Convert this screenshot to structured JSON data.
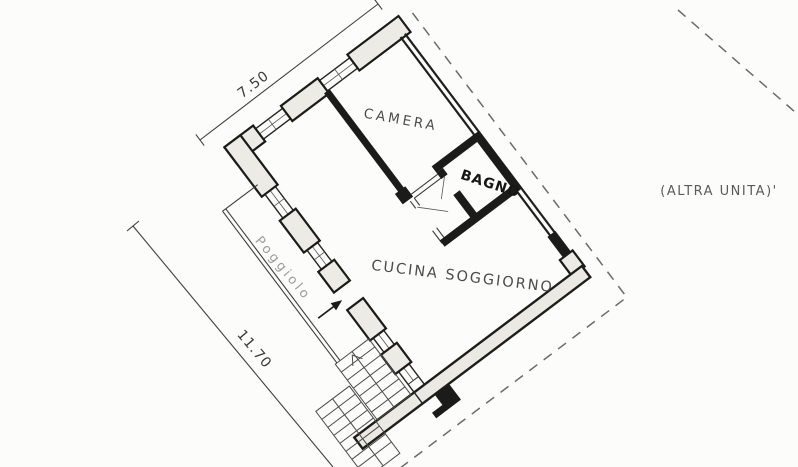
{
  "plan": {
    "rooms": [
      {
        "name": "CAMERA"
      },
      {
        "name": "BAGNO"
      },
      {
        "name": "CUCINA SOGGIORNO"
      }
    ],
    "balcony": {
      "label": "Poggiolo"
    },
    "adjacent_unit": {
      "label": "(ALTRA UNITA)'"
    },
    "dimensions": [
      {
        "side": "northwest",
        "value": "7.50"
      },
      {
        "side": "southwest",
        "value": "11.70"
      }
    ],
    "colors": {
      "wall": "#1b1b19",
      "wall_fill": "#ecebe6",
      "thin_line": "#3c3c3a",
      "dashed_boundary": "#6b6b67",
      "room_label": "#4c4c48",
      "balcony_label": "#9c9c98",
      "background": "#fcfcfa"
    }
  }
}
